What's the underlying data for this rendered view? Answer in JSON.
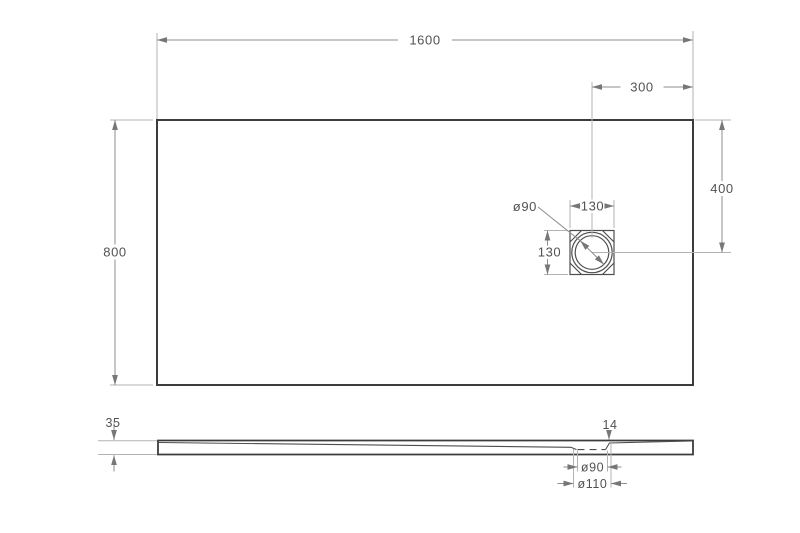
{
  "drawing": {
    "kind": "shower-tray technical drawing, top view and side profile",
    "background": "#ffffff",
    "colors": {
      "outline": "#3c3c3c",
      "detail_line": "#4e4e4e",
      "dimension_line": "#8e8e8e",
      "extension_line": "#b3b3b3",
      "text": "#525252"
    },
    "top_view": {
      "overall_width": "1600",
      "overall_depth": "800",
      "drain_offset_from_right": "300",
      "drain_offset_from_top": "400",
      "drain_box_width": "130",
      "drain_box_height": "130",
      "drain_diameter": "ø90"
    },
    "side_view": {
      "edge_thickness": "35",
      "drain_zone_thickness": "14",
      "drain_hole_diameter": "ø90",
      "drain_recess_diameter": "ø110"
    }
  }
}
